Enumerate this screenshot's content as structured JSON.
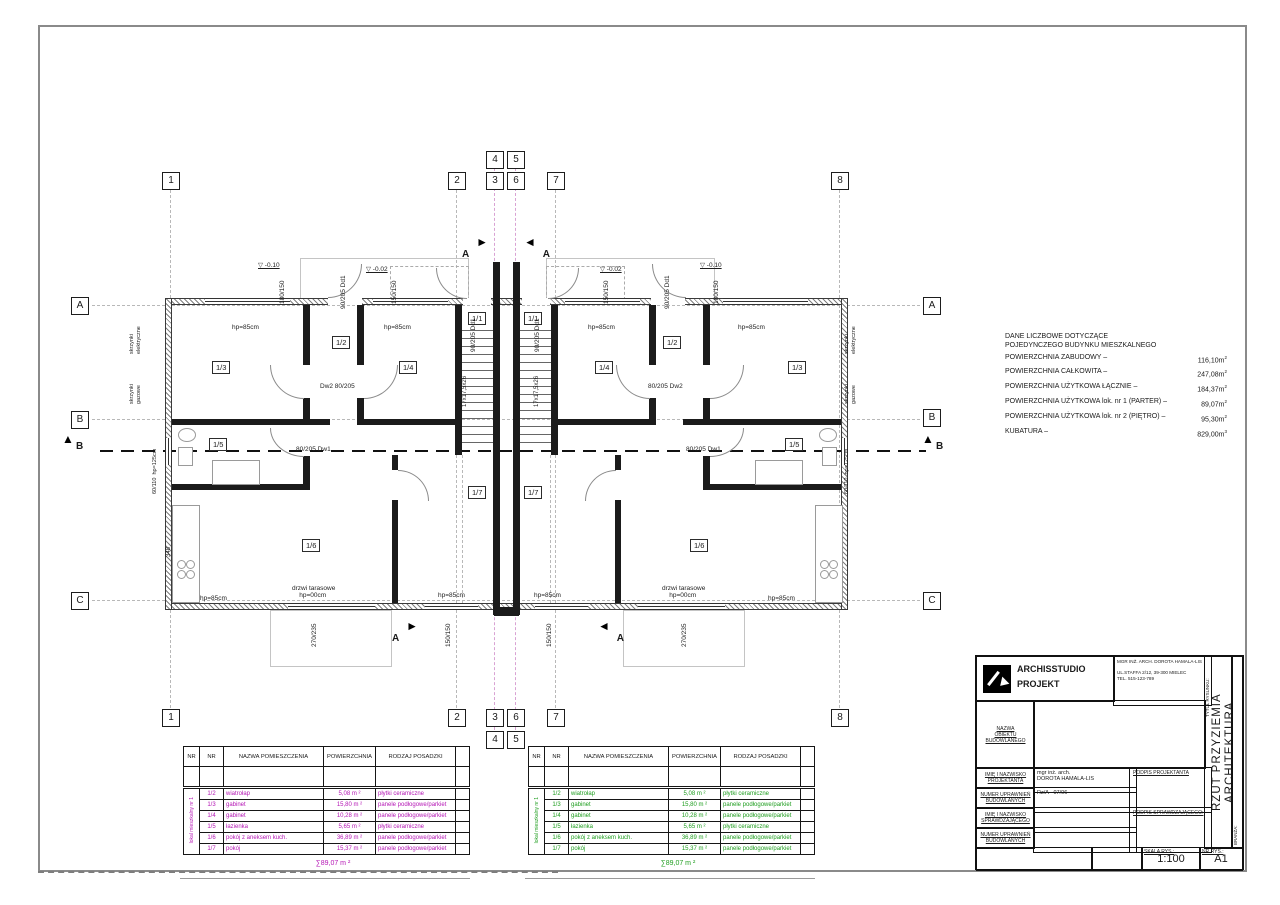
{
  "info_block": {
    "heading": "DANE LICZBOWE DOTYCZĄCE\nPOJEDYNCZEGO BUDYNKU MIESZKALNEGO",
    "items": [
      {
        "label": "POWIERZCHNIA ZABUDOWY –",
        "value": "116,10m",
        "sup": "2"
      },
      {
        "label": "POWIERZCHNIA CAŁKOWITA –",
        "value": "247,08m",
        "sup": "2"
      },
      {
        "label": "POWIERZCHNIA UŻYTKOWA ŁĄCZNIE –",
        "value": "184,37m",
        "sup": "2"
      },
      {
        "label": "POWIERZCHNIA UŻYTKOWA lok. nr 1 (PARTER) –",
        "value": "89,07m",
        "sup": "2"
      },
      {
        "label": "POWIERZCHNIA UŻYTKOWA lok. nr 2 (PIĘTRO) –",
        "value": "95,30m",
        "sup": "2"
      },
      {
        "label": "KUBATURA –",
        "value": "829,00m",
        "sup": "3"
      }
    ]
  },
  "room_tables": [
    {
      "accent": "#b517b5",
      "group_label": "lokal mieszkalny nr 1",
      "headers": [
        "NR",
        "NR",
        "NAZWA POMIESZCZENIA",
        "POWIERZCHNIA",
        "RODZAJ POSADZKI",
        ""
      ],
      "rows": [
        {
          "no": "1/2",
          "name": "wiatrołap",
          "area": "5,08 m ²",
          "floor": "płytki ceramiczne"
        },
        {
          "no": "1/3",
          "name": "gabinet",
          "area": "15,80 m ²",
          "floor": "panele podłogowe/parkiet"
        },
        {
          "no": "1/4",
          "name": "gabinet",
          "area": "10,28 m ²",
          "floor": "panele podłogowe/parkiet"
        },
        {
          "no": "1/5",
          "name": "łazienka",
          "area": "5,65 m ²",
          "floor": "płytki ceramiczne"
        },
        {
          "no": "1/6",
          "name": "pokój z aneksem kuch.",
          "area": "36,89 m ²",
          "floor": "panele podłogowe/parkiet"
        },
        {
          "no": "1/7",
          "name": "pokój",
          "area": "15,37 m ²",
          "floor": "panele podłogowe/parkiet"
        }
      ],
      "sum": "∑89,07 m ²"
    },
    {
      "accent": "#1f9e1f",
      "group_label": "lokal mieszkalny nr 1",
      "headers": [
        "NR",
        "NR",
        "NAZWA POMIESZCZENIA",
        "POWIERZCHNIA",
        "RODZAJ POSADZKI",
        ""
      ],
      "rows": [
        {
          "no": "1/2",
          "name": "wiatrołap",
          "area": "5,08 m ²",
          "floor": "płytki ceramiczne"
        },
        {
          "no": "1/3",
          "name": "gabinet",
          "area": "15,80 m ²",
          "floor": "panele podłogowe/parkiet"
        },
        {
          "no": "1/4",
          "name": "gabinet",
          "area": "10,28 m ²",
          "floor": "panele podłogowe/parkiet"
        },
        {
          "no": "1/5",
          "name": "łazienka",
          "area": "5,65 m ²",
          "floor": "płytki ceramiczne"
        },
        {
          "no": "1/6",
          "name": "pokój z aneksem kuch.",
          "area": "36,89 m ²",
          "floor": "panele podłogowe/parkiet"
        },
        {
          "no": "1/7",
          "name": "pokój",
          "area": "15,37 m ²",
          "floor": "panele podłogowe/parkiet"
        }
      ],
      "sum": "∑89,07 m ²"
    }
  ],
  "plan": {
    "grid_bubbles": [
      {
        "label": "1",
        "x": 162,
        "y": 172
      },
      {
        "label": "2",
        "x": 448,
        "y": 172
      },
      {
        "label": "4",
        "x": 486,
        "y": 151
      },
      {
        "label": "3",
        "x": 486,
        "y": 172
      },
      {
        "label": "5",
        "x": 507,
        "y": 151
      },
      {
        "label": "6",
        "x": 507,
        "y": 172
      },
      {
        "label": "7",
        "x": 547,
        "y": 172
      },
      {
        "label": "8",
        "x": 831,
        "y": 172
      },
      {
        "label": "1",
        "x": 162,
        "y": 709
      },
      {
        "label": "2",
        "x": 448,
        "y": 709
      },
      {
        "label": "3",
        "x": 486,
        "y": 709
      },
      {
        "label": "4",
        "x": 486,
        "y": 731
      },
      {
        "label": "6",
        "x": 507,
        "y": 709
      },
      {
        "label": "5",
        "x": 507,
        "y": 731
      },
      {
        "label": "7",
        "x": 547,
        "y": 709
      },
      {
        "label": "8",
        "x": 831,
        "y": 709
      },
      {
        "label": "A",
        "x": 71,
        "y": 297
      },
      {
        "label": "B",
        "x": 71,
        "y": 411
      },
      {
        "label": "C",
        "x": 71,
        "y": 592
      },
      {
        "label": "A",
        "x": 923,
        "y": 297
      },
      {
        "label": "B",
        "x": 923,
        "y": 409
      },
      {
        "label": "C",
        "x": 923,
        "y": 592
      }
    ],
    "rooms": [
      {
        "t": "1/3",
        "x": 212,
        "y": 361
      },
      {
        "t": "1/2",
        "x": 332,
        "y": 336
      },
      {
        "t": "1/4",
        "x": 399,
        "y": 361
      },
      {
        "t": "1/1",
        "x": 468,
        "y": 312
      },
      {
        "t": "1/5",
        "x": 209,
        "y": 438
      },
      {
        "t": "1/6",
        "x": 302,
        "y": 539
      },
      {
        "t": "1/7",
        "x": 468,
        "y": 486
      },
      {
        "t": "1/1",
        "x": 524,
        "y": 312
      },
      {
        "t": "1/4",
        "x": 595,
        "y": 361
      },
      {
        "t": "1/2",
        "x": 663,
        "y": 336
      },
      {
        "t": "1/3",
        "x": 788,
        "y": 361
      },
      {
        "t": "1/5",
        "x": 785,
        "y": 438
      },
      {
        "t": "1/6",
        "x": 690,
        "y": 539
      },
      {
        "t": "1/7",
        "x": 524,
        "y": 486
      }
    ],
    "annotations": [
      {
        "t": "▽ -0.10",
        "x": 258,
        "y": 262,
        "u": 1
      },
      {
        "t": "▽ -0.02",
        "x": 366,
        "y": 266,
        "u": 1
      },
      {
        "t": "▽ -0.02",
        "x": 600,
        "y": 266,
        "u": 1
      },
      {
        "t": "▽ -0.10",
        "x": 700,
        "y": 262,
        "u": 1
      },
      {
        "t": "hp=85cm",
        "x": 232,
        "y": 324
      },
      {
        "t": "hp=85cm",
        "x": 384,
        "y": 324
      },
      {
        "t": "hp=85cm",
        "x": 588,
        "y": 324
      },
      {
        "t": "hp=85cm",
        "x": 738,
        "y": 324
      },
      {
        "t": "hp=85cm",
        "x": 200,
        "y": 595
      },
      {
        "t": "hp=85cm",
        "x": 438,
        "y": 592
      },
      {
        "t": "hp=85cm",
        "x": 534,
        "y": 592
      },
      {
        "t": "hp=85cm",
        "x": 768,
        "y": 595
      },
      {
        "t": "drzwi tarasowe\n    hp=00cm",
        "x": 292,
        "y": 585
      },
      {
        "t": "drzwi tarasowe\n    hp=00cm",
        "x": 662,
        "y": 585
      },
      {
        "t": "180/150",
        "x": 286,
        "y": 297,
        "r": -90
      },
      {
        "t": "150/150",
        "x": 398,
        "y": 297,
        "r": -90
      },
      {
        "t": "150/150",
        "x": 610,
        "y": 297,
        "r": -90
      },
      {
        "t": "180/150",
        "x": 720,
        "y": 297,
        "r": -90
      },
      {
        "t": "90/205 Dd1",
        "x": 347,
        "y": 302,
        "r": -90
      },
      {
        "t": "90/205 Dd1",
        "x": 671,
        "y": 302,
        "r": -90
      },
      {
        "t": "90/205 Dd1",
        "x": 477,
        "y": 345,
        "r": -90
      },
      {
        "t": "90/205 Dd1",
        "x": 541,
        "y": 345,
        "r": -90
      },
      {
        "t": "Dw2 80/205",
        "x": 320,
        "y": 383
      },
      {
        "t": "80/205 Dw2",
        "x": 648,
        "y": 383
      },
      {
        "t": "80/205 Dw1",
        "x": 296,
        "y": 446
      },
      {
        "t": "80/205 Dw1",
        "x": 686,
        "y": 446
      },
      {
        "t": "270/235",
        "x": 318,
        "y": 640,
        "r": -90
      },
      {
        "t": "150/150",
        "x": 452,
        "y": 640,
        "r": -90
      },
      {
        "t": "150/150",
        "x": 553,
        "y": 640,
        "r": -90
      },
      {
        "t": "270/235",
        "x": 688,
        "y": 640,
        "r": -90
      },
      {
        "t": "60/110  hp=125cm",
        "x": 159,
        "y": 487,
        "r": -90,
        "s": 5.5
      },
      {
        "t": "60/110  hp=125cm",
        "x": 851,
        "y": 487,
        "r": -90,
        "s": 5.5
      },
      {
        "t": "skrzynki\nelektryczne",
        "x": 143,
        "y": 340,
        "r": -90,
        "s": 5.5
      },
      {
        "t": "skrzynki\ngazowe",
        "x": 143,
        "y": 390,
        "r": -90,
        "s": 5.5
      },
      {
        "t": "skrzynki\nelektryczne",
        "x": 858,
        "y": 340,
        "r": -90,
        "s": 5.5
      },
      {
        "t": "skrzynki\ngazowe",
        "x": 858,
        "y": 390,
        "r": -90,
        "s": 5.5
      },
      {
        "t": "17x17,5x26",
        "x": 469,
        "y": 400,
        "r": -90,
        "s": 6
      },
      {
        "t": "17x17,5x26",
        "x": 541,
        "y": 400,
        "r": -90,
        "s": 6
      },
      {
        "t": "348",
        "x": 173,
        "y": 550,
        "r": -90,
        "s": 6
      }
    ],
    "section_flags": [
      {
        "label": "A",
        "x": 462,
        "y": 236,
        "dir": "r"
      },
      {
        "label": "A",
        "x": 524,
        "y": 236,
        "dir": "l"
      },
      {
        "label": "A",
        "x": 392,
        "y": 620,
        "dir": "r"
      },
      {
        "label": "A",
        "x": 598,
        "y": 620,
        "dir": "l"
      },
      {
        "label": "B",
        "x": 60,
        "y": 433,
        "dir": "u"
      },
      {
        "label": "B",
        "x": 920,
        "y": 433,
        "dir": "u"
      }
    ]
  },
  "title_block": {
    "logo_line1": "ARCHISSTUDIO",
    "logo_line2": "PROJEKT",
    "architect_lines": "MGR INŻ. ARCH. DOROTA HAMALA-LIS\n\nUL.STAFFA 2/12, 39-300 MIELEC\nTEL. 515-123-789",
    "fields": {
      "nazwa_label": "NAZWA\nOBIEKTU\nBUDOWLANEGO",
      "proj_label": "IMIĘ I NAZWISKO\nPROJEKTANTA",
      "proj_value": "mgr inż. arch.\nDOROTA HAMALA-LIS",
      "podpis_proj": "PODPIS PROJEKTANTA",
      "upr1_label": "NUMER UPRAWNIEŃ\nBUDOWLANYCH",
      "upr1_value": "Rz/A - 07/06",
      "sprawdz_label": "IMIĘ I NAZWISKO\nSPRAWDZAJĄCEGO",
      "sprawdz_value": "–",
      "podpis_spr": "PODPIS SPRAWDZAJĄCEGO:",
      "upr2_label": "NUMER UPRAWNIEŃ\nBUDOWLANYCH",
      "upr2_value": "–"
    },
    "scale_label": "SKALA RYS.:",
    "scale_value": "1:100",
    "no_label": "NR RYS.:",
    "no_value": "A1",
    "drawing_title_label": "TYTUŁ RYSUNKU:",
    "drawing_title": "RZUT PRZYZIEMIA\nARCHITEKTURA",
    "branza_label": "BRANŻA:"
  }
}
